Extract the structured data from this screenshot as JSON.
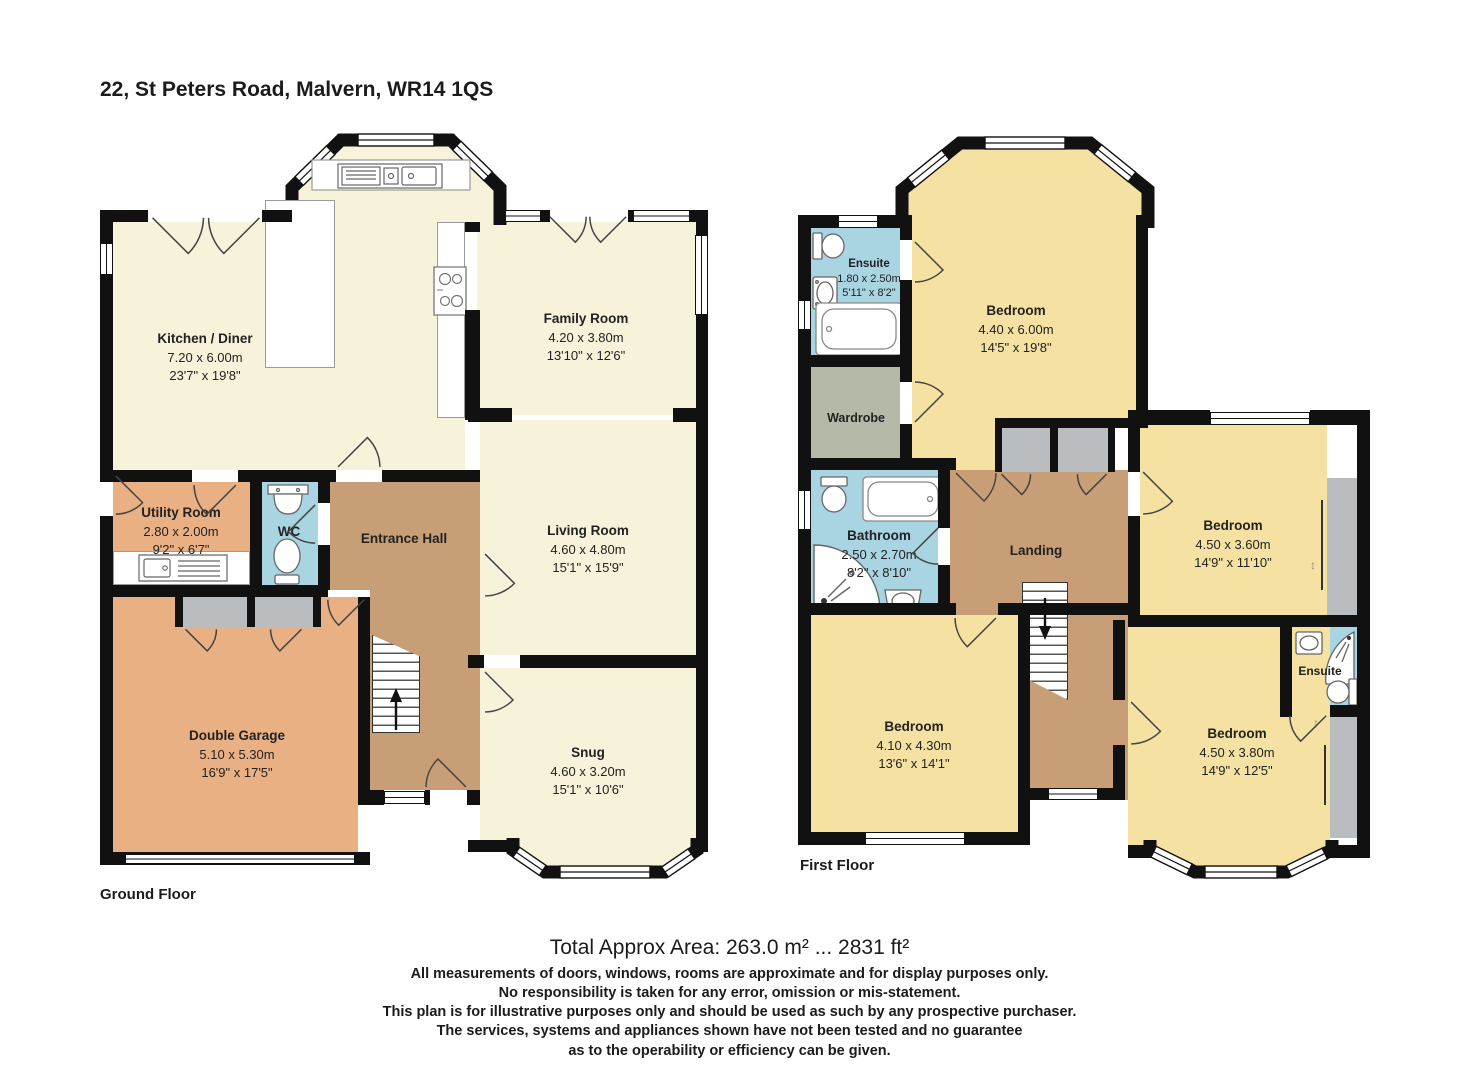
{
  "title": "22, St Peters Road, Malvern, WR14 1QS",
  "floors": {
    "ground": {
      "label": "Ground Floor",
      "rooms": {
        "kitchen": {
          "name": "Kitchen / Diner",
          "metric": "7.20 x 6.00m",
          "imperial": "23'7\" x 19'8\""
        },
        "family": {
          "name": "Family Room",
          "metric": "4.20 x 3.80m",
          "imperial": "13'10\" x 12'6\""
        },
        "living": {
          "name": "Living Room",
          "metric": "4.60 x 4.80m",
          "imperial": "15'1\" x 15'9\""
        },
        "snug": {
          "name": "Snug",
          "metric": "4.60 x 3.20m",
          "imperial": "15'1\" x 10'6\""
        },
        "utility": {
          "name": "Utility Room",
          "metric": "2.80 x 2.00m",
          "imperial": "9'2\" x 6'7\""
        },
        "wc": {
          "name": "WC"
        },
        "hall": {
          "name": "Entrance Hall"
        },
        "garage": {
          "name": "Double Garage",
          "metric": "5.10 x 5.30m",
          "imperial": "16'9\" x 17'5\""
        }
      }
    },
    "first": {
      "label": "First Floor",
      "rooms": {
        "ensuite1": {
          "name": "Ensuite",
          "metric": "1.80 x 2.50m",
          "imperial": "5'11\" x 8'2\""
        },
        "wardrobe": {
          "name": "Wardrobe"
        },
        "bedroom1": {
          "name": "Bedroom",
          "metric": "4.40 x 6.00m",
          "imperial": "14'5\" x 19'8\""
        },
        "bathroom": {
          "name": "Bathroom",
          "metric": "2.50 x 2.70m",
          "imperial": "8'2\" x 8'10\""
        },
        "landing": {
          "name": "Landing"
        },
        "bedroom2": {
          "name": "Bedroom",
          "metric": "4.10 x 4.30m",
          "imperial": "13'6\" x 14'1\""
        },
        "bedroom3": {
          "name": "Bedroom",
          "metric": "4.50 x 3.60m",
          "imperial": "14'9\" x 11'10\""
        },
        "ensuite2": {
          "name": "Ensuite"
        },
        "bedroom4": {
          "name": "Bedroom",
          "metric": "4.50 x 3.80m",
          "imperial": "14'9\" x 12'5\""
        }
      }
    }
  },
  "footer": {
    "area": "Total Approx Area: 263.0 m² ... 2831 ft²",
    "disclaimers": [
      "All measurements of doors, windows, rooms are approximate and for display purposes only.",
      "No responsibility is taken for any error, omission or mis-statement.",
      "This plan is for illustrative purposes only and should be used as such by any prospective purchaser.",
      "The services, systems and appliances shown have not been tested and no guarantee",
      "as to the operability or efficiency can be given."
    ]
  },
  "colors": {
    "floor_cream": "#f7f2da",
    "floor_yellow": "#f5e1a2",
    "floor_tan": "#e9b083",
    "floor_brown": "#c79e75",
    "floor_blue": "#a9d4e1",
    "storage_gray": "#b9bdbf",
    "wardrobe_sage": "#b4baa7",
    "wall": "#111111"
  }
}
